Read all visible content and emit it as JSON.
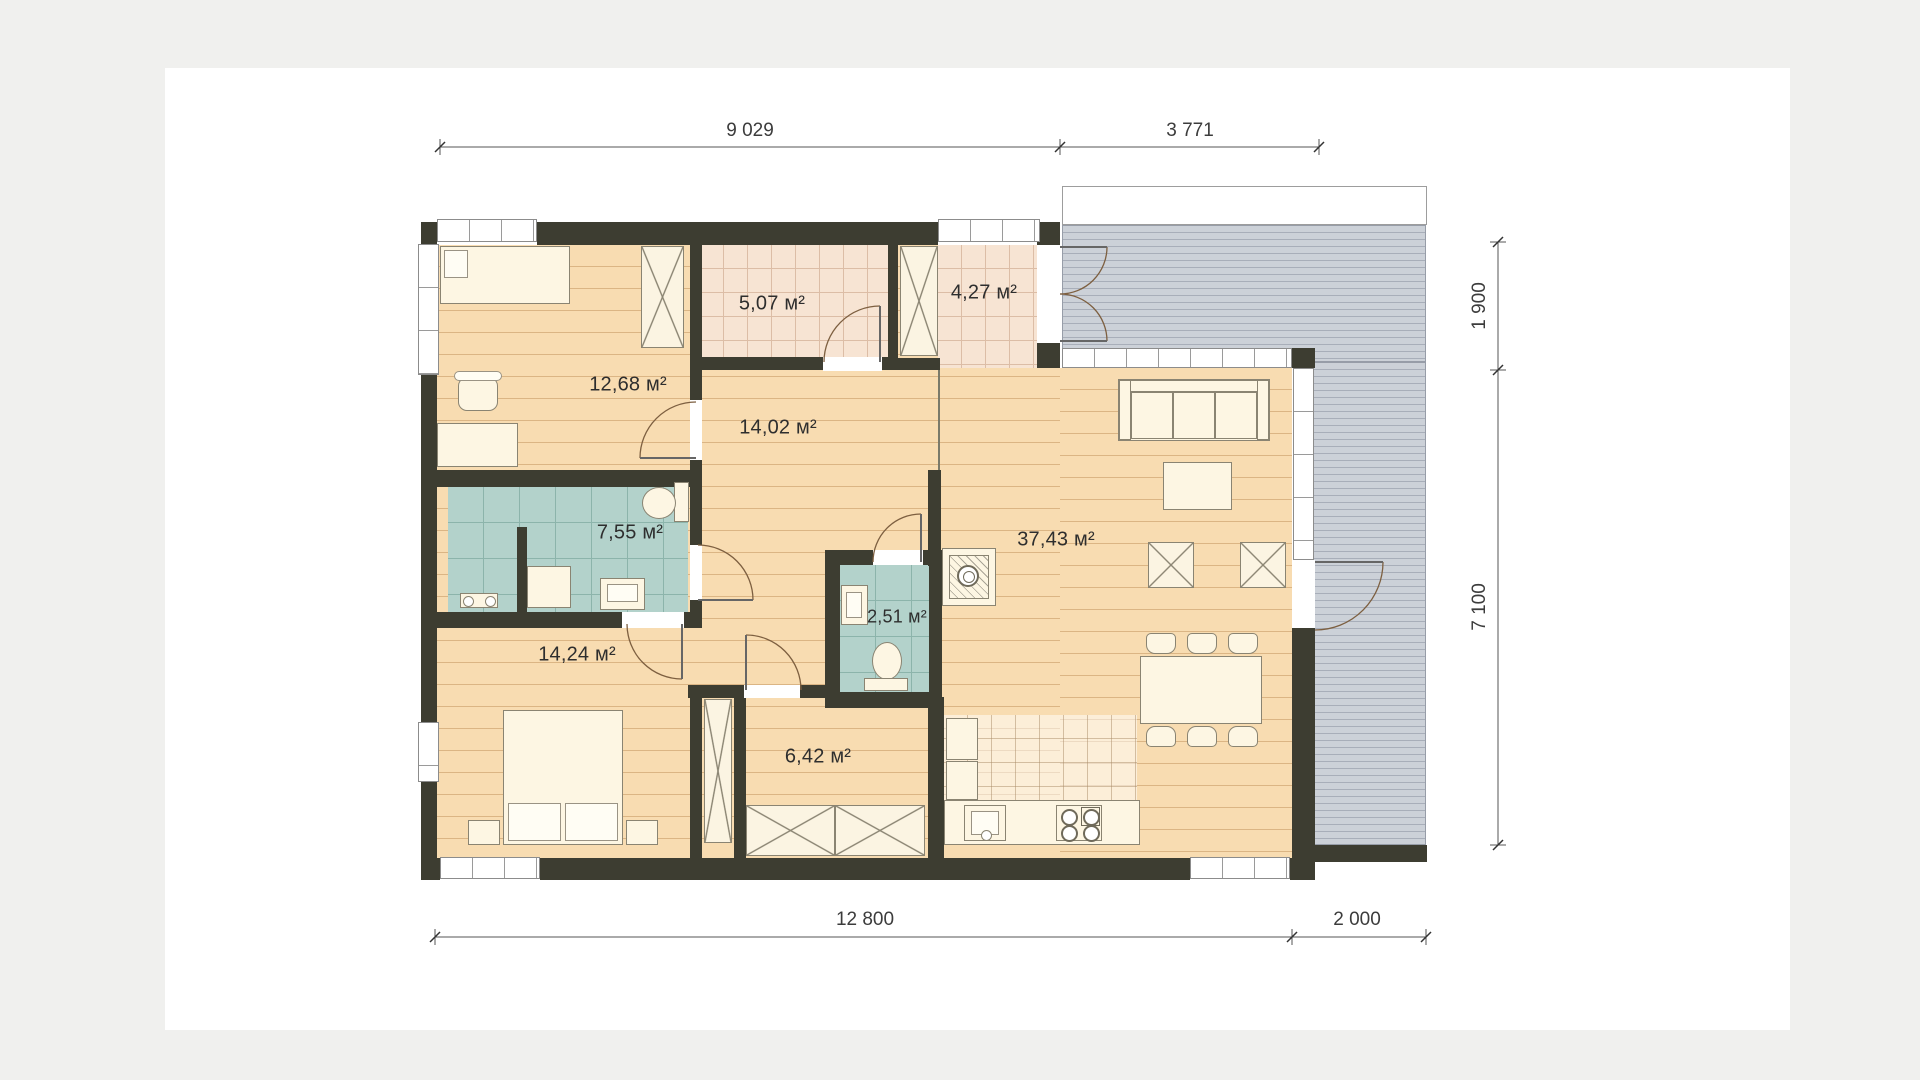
{
  "floor_plan": {
    "rooms": [
      {
        "name": "bedroom-top-left",
        "area_label": "12,68 м²"
      },
      {
        "name": "vestibule",
        "area_label": "5,07 м²"
      },
      {
        "name": "entry-hall",
        "area_label": "4,27 м²"
      },
      {
        "name": "hallway",
        "area_label": "14,02 м²"
      },
      {
        "name": "bathroom",
        "area_label": "7,55 м²"
      },
      {
        "name": "wc",
        "area_label": "2,51 м²"
      },
      {
        "name": "living-dining",
        "area_label": "37,43 м²"
      },
      {
        "name": "bedroom-bottom-left",
        "area_label": "14,24 м²"
      },
      {
        "name": "inner-hall",
        "area_label": "6,42 м²"
      }
    ],
    "dimensions": {
      "top_left": "9 029",
      "top_right": "3 771",
      "right_upper": "1 900",
      "right_lower": "7 100",
      "bottom_left": "12 800",
      "bottom_right": "2 000"
    },
    "colors": {
      "wall": "#3d3d31",
      "wood_floor": "#f8dcb1",
      "tile_floor": "#f7e4d3",
      "wet_room_tile": "#b3d2cb",
      "terrace_deck": "#ccd1d8",
      "paper": "#ffffff",
      "page_background": "#f0f0ee"
    }
  }
}
